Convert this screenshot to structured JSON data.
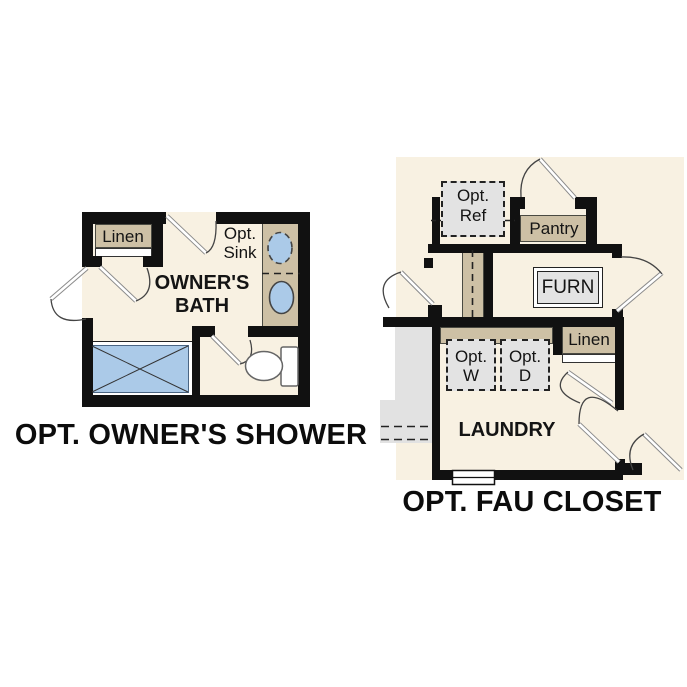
{
  "colors": {
    "wall": "#111111",
    "floor": "#f8f1e2",
    "tan": "#cdc0a5",
    "gray": "#e3e3e3",
    "blue": "#abcae8",
    "adjacent": "#e2e2e2"
  },
  "plans": {
    "owners_shower": {
      "caption": "OPT. OWNER'S SHOWER",
      "room": {
        "line1": "OWNER'S",
        "line2": "BATH"
      },
      "linen": "Linen",
      "opt_sink": {
        "line1": "Opt.",
        "line2": "Sink"
      }
    },
    "fau_closet": {
      "caption": "OPT. FAU CLOSET",
      "room": "LAUNDRY",
      "opt_ref": {
        "line1": "Opt.",
        "line2": "Ref"
      },
      "pantry": "Pantry",
      "furn": "FURN",
      "linen": "Linen",
      "opt_w": {
        "line1": "Opt.",
        "line2": "W"
      },
      "opt_d": {
        "line1": "Opt.",
        "line2": "D"
      }
    }
  }
}
